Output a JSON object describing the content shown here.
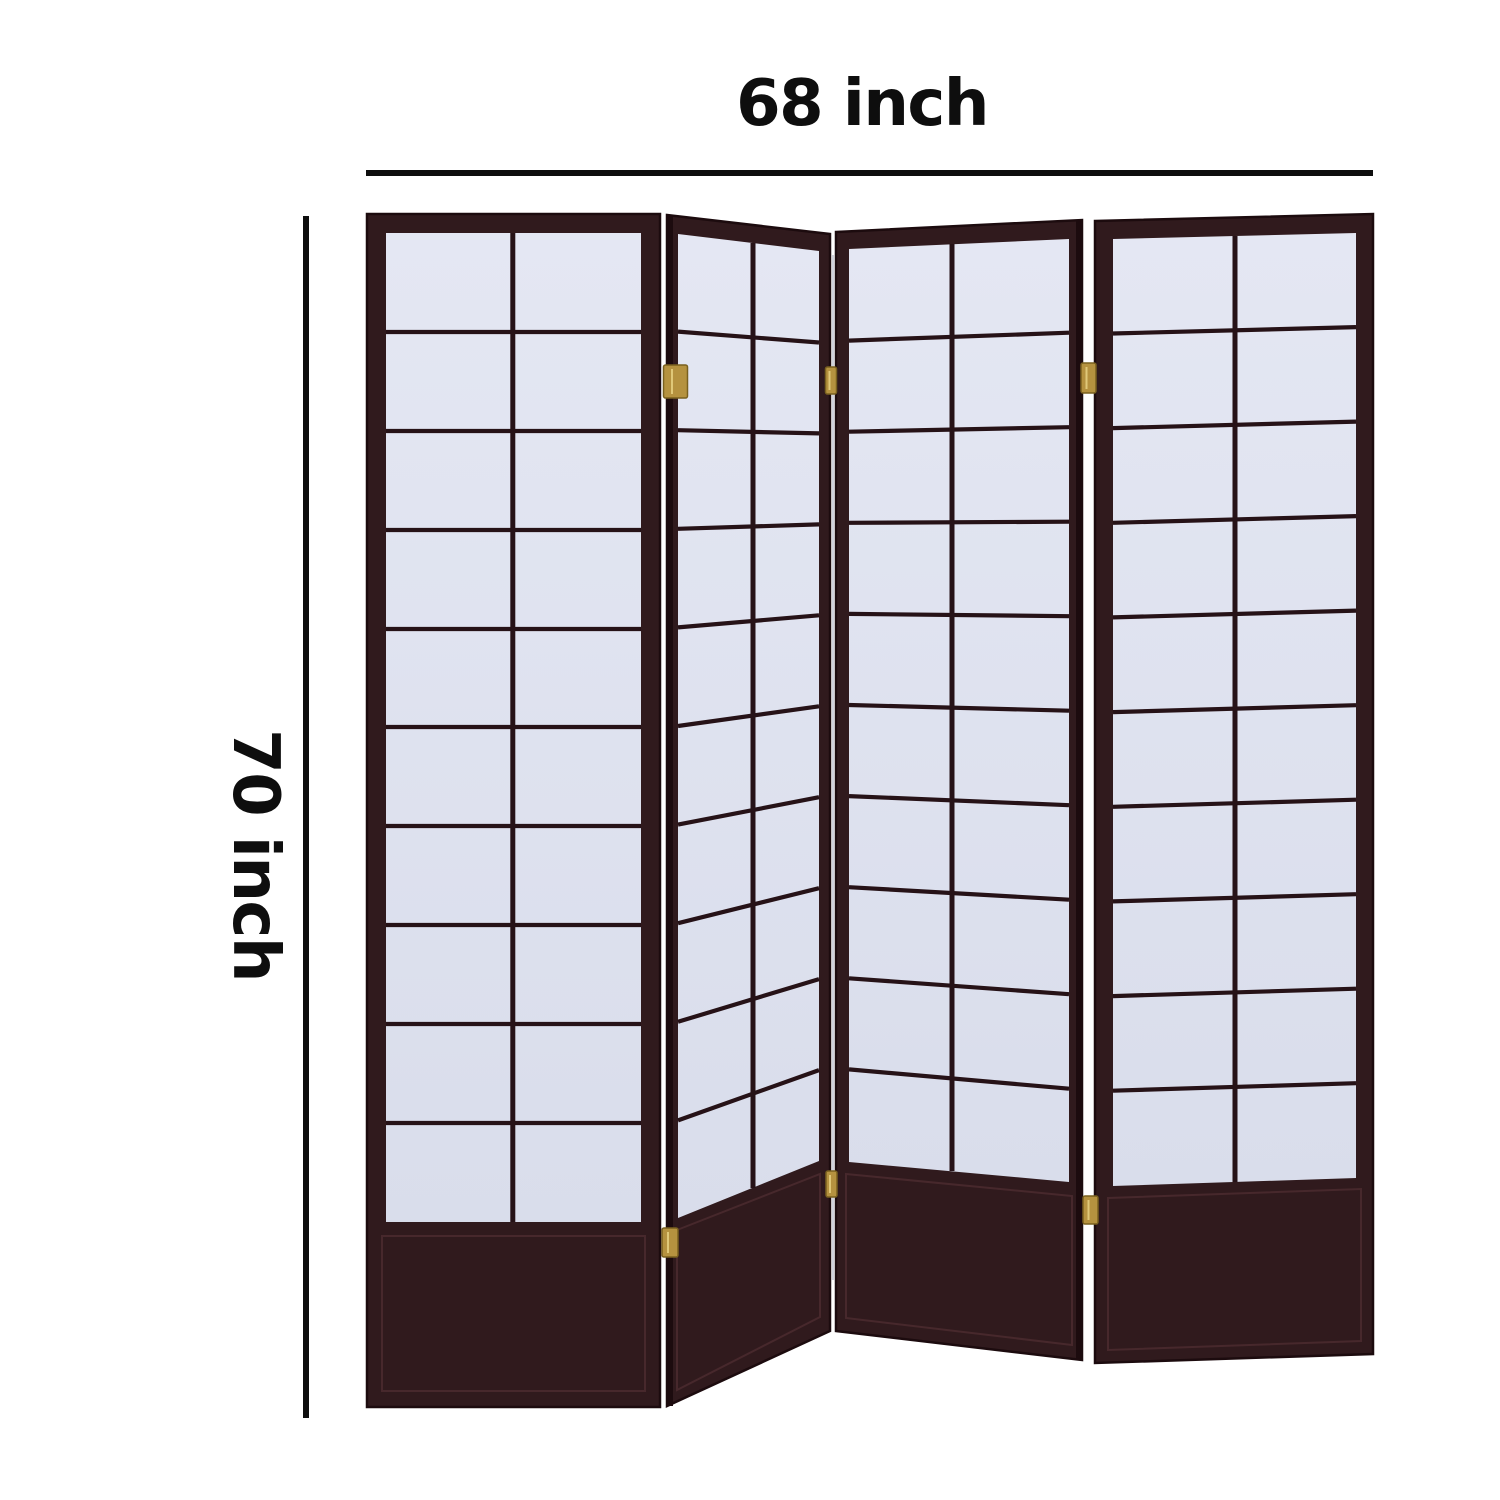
{
  "meta": {
    "description": "Product dimension diagram of a 4 panel shoji style folding room divider screen"
  },
  "dimensions": {
    "width_label": "68 inch",
    "height_label": "70 inch"
  },
  "product": {
    "name": "4 Panel Shoji Screen Room Divider",
    "panel_count": 4,
    "grid_columns_per_panel": 2,
    "grid_rows_per_panel": 10,
    "visible_hinge_count": 6
  },
  "colors": {
    "background": "#ffffff",
    "frame": "#301a1d",
    "frame-dark": "#1c0b0e",
    "frame-light": "#4b2c2f",
    "paper": "#e4e7f3",
    "paper-dim": "#d9ddeb",
    "grid-line": "#261217",
    "hinge": "#b5923f",
    "hinge-dark": "#79601f",
    "dimension": "#0e0e0e"
  }
}
